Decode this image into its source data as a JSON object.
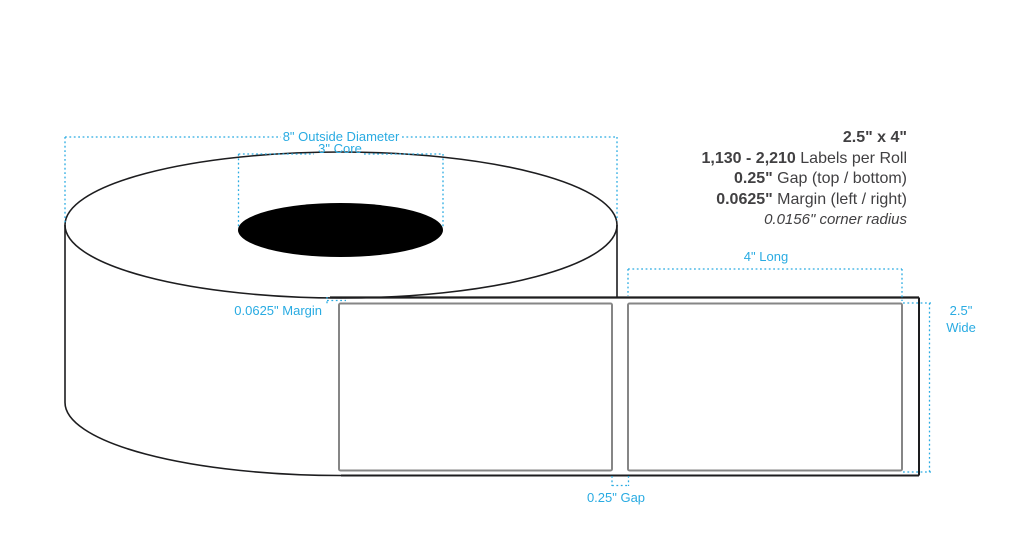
{
  "title": "Label roll specification diagram",
  "colors": {
    "accent_blue": "#29ABE2",
    "text_dark": "#414042",
    "label_border": "#868686",
    "outline_black": "#1D1D1F",
    "core_fill": "#000000",
    "background": "#FFFFFF"
  },
  "spec_panel": {
    "size": "2.5\" x 4\"",
    "rows": [
      {
        "value": "1,130 - 2,210",
        "label": " Labels per Roll"
      },
      {
        "value": "0.25\"",
        "label": " Gap (top / bottom)"
      },
      {
        "value": "0.0625\"",
        "label": " Margin (left / right)"
      }
    ],
    "corner_radius": "0.0156\" corner radius"
  },
  "dimension_labels": {
    "outside_diameter": "8\" Outside Diameter",
    "core": "3\" Core",
    "margin": "0.0625\" Margin",
    "long": "4\" Long",
    "wide_line1": "2.5\"",
    "wide_line2": "Wide",
    "gap": "0.25\" Gap"
  }
}
